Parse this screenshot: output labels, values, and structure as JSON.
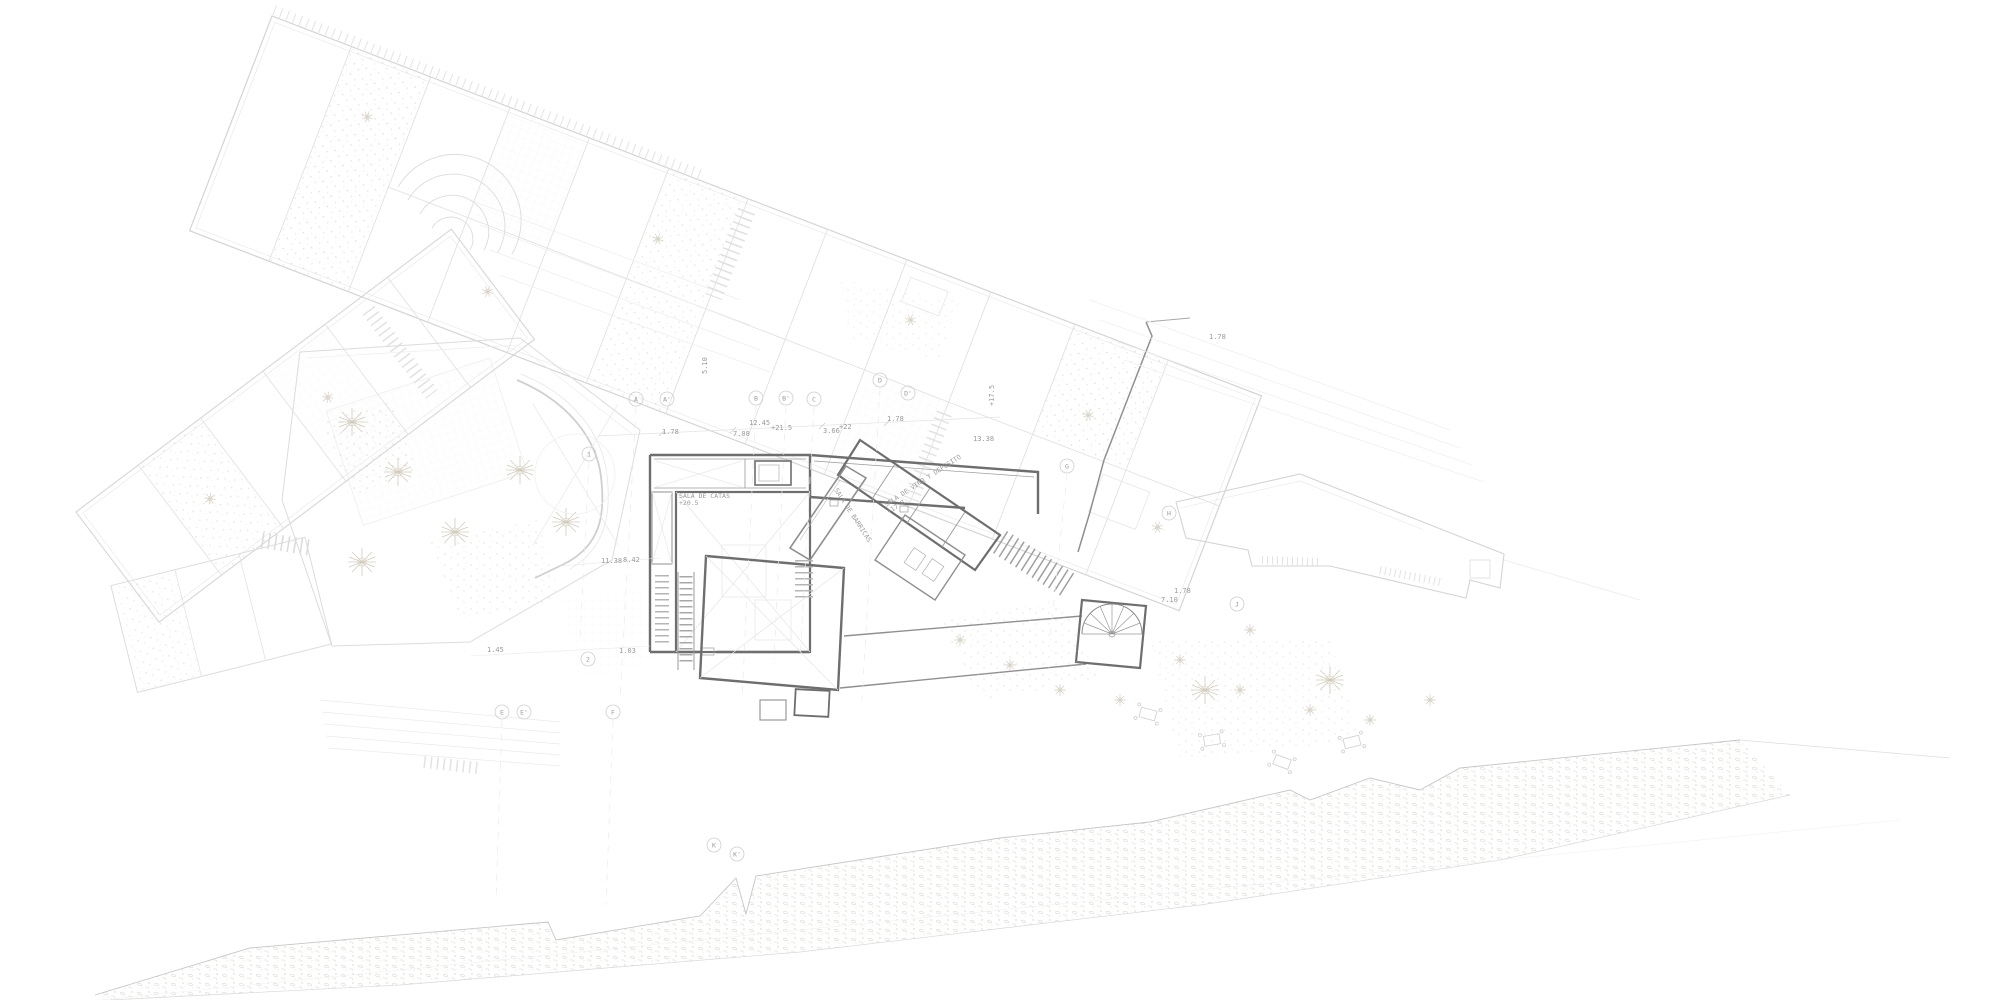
{
  "meta": {
    "drawing_type": "architectural site / ground-floor plan",
    "style": "very light CAD linework on white paper"
  },
  "palette": {
    "paper": "#ffffff",
    "line_faintest": "#efefef",
    "line_faint": "#e4e4e4",
    "line_light": "#d6d6d6",
    "line_mid": "#c2c2c2",
    "wall_medium": "#8f8f8f",
    "wall_dark": "#6e6e6e",
    "annotation_text": "#9a9a9a",
    "vegetation": "#d8d2c6",
    "rock": "#c9c0b2"
  },
  "room_labels": [
    {
      "text": "SALA DE CATAS",
      "x": 679,
      "y": 498,
      "rot": 0
    },
    {
      "text": "+20.5",
      "x": 679,
      "y": 505,
      "rot": 0
    },
    {
      "text": "SALA DE BARRICAS",
      "x": 834,
      "y": 490,
      "rot": 57
    },
    {
      "text": "SALA DE VINO Y DEPOSITO",
      "x": 886,
      "y": 507,
      "rot": -33
    },
    {
      "text": "+17.8",
      "x": 889,
      "y": 514,
      "rot": -33
    }
  ],
  "dimension_annotations": [
    {
      "text": "1.78",
      "x": 662,
      "y": 434,
      "rot": 0
    },
    {
      "text": "7.08",
      "x": 733,
      "y": 436,
      "rot": 0
    },
    {
      "text": "12.45",
      "x": 749,
      "y": 425,
      "rot": 0
    },
    {
      "text": "+21.5",
      "x": 771,
      "y": 430,
      "rot": 0
    },
    {
      "text": "3.66",
      "x": 823,
      "y": 433,
      "rot": 0
    },
    {
      "text": "+22",
      "x": 839,
      "y": 429,
      "rot": 0
    },
    {
      "text": "1.78",
      "x": 887,
      "y": 421,
      "rot": 0
    },
    {
      "text": "5.10",
      "x": 707,
      "y": 374,
      "rot": -90
    },
    {
      "text": "+17.5",
      "x": 994,
      "y": 406,
      "rot": -90
    },
    {
      "text": "13.38",
      "x": 973,
      "y": 441,
      "rot": 0
    },
    {
      "text": "1.78",
      "x": 1209,
      "y": 339,
      "rot": 0
    },
    {
      "text": "11.38",
      "x": 601,
      "y": 563,
      "rot": 0
    },
    {
      "text": "8.42",
      "x": 623,
      "y": 562,
      "rot": 0
    },
    {
      "text": "1.45",
      "x": 487,
      "y": 652,
      "rot": 0
    },
    {
      "text": "1.03",
      "x": 619,
      "y": 653,
      "rot": 0
    },
    {
      "text": "1.78",
      "x": 1174,
      "y": 593,
      "rot": 0
    },
    {
      "text": "7.10",
      "x": 1161,
      "y": 602,
      "rot": 0
    }
  ],
  "grid_bubbles": [
    {
      "label": "A",
      "x": 636,
      "y": 399
    },
    {
      "label": "A'",
      "x": 667,
      "y": 399
    },
    {
      "label": "B",
      "x": 756,
      "y": 398
    },
    {
      "label": "B'",
      "x": 786,
      "y": 398
    },
    {
      "label": "C",
      "x": 814,
      "y": 399
    },
    {
      "label": "D",
      "x": 880,
      "y": 380
    },
    {
      "label": "D'",
      "x": 908,
      "y": 393
    },
    {
      "label": "1",
      "x": 589,
      "y": 454
    },
    {
      "label": "2",
      "x": 588,
      "y": 659
    },
    {
      "label": "E",
      "x": 502,
      "y": 712
    },
    {
      "label": "E'",
      "x": 524,
      "y": 712
    },
    {
      "label": "F",
      "x": 613,
      "y": 712
    },
    {
      "label": "G",
      "x": 1067,
      "y": 466
    },
    {
      "label": "H",
      "x": 1169,
      "y": 513
    },
    {
      "label": "J",
      "x": 1237,
      "y": 604
    },
    {
      "label": "K",
      "x": 714,
      "y": 845
    },
    {
      "label": "K'",
      "x": 737,
      "y": 854
    }
  ]
}
